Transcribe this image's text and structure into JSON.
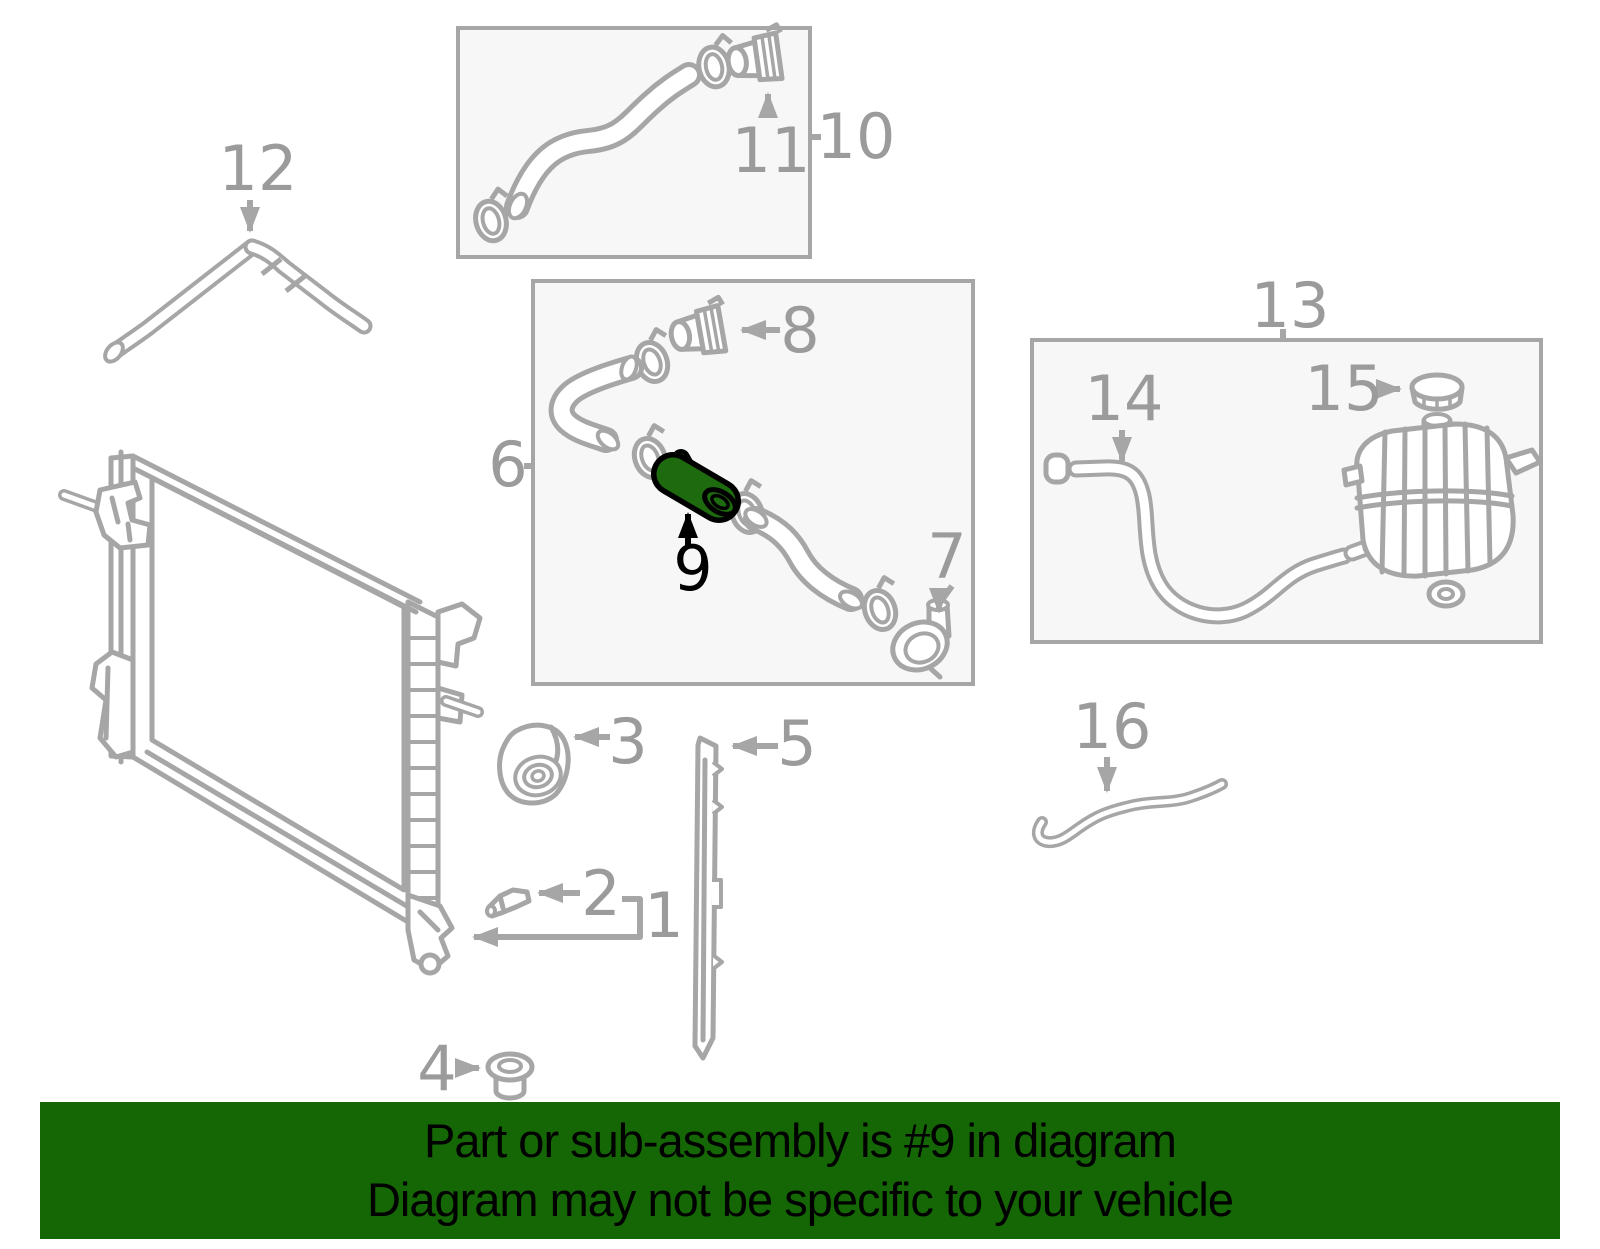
{
  "banner": {
    "line1": "Part or sub-assembly is #9 in diagram",
    "line2": "Diagram may not be specific to your vehicle",
    "background_color": "#156605",
    "text_color": "#000000"
  },
  "diagram": {
    "highlighted_callout": "9",
    "line_color": "#a6a6a6",
    "label_color": "#9b9b9b",
    "box_fill": "#f7f7f7",
    "highlight_fill": "#1e6a0e",
    "highlight_outline": "#000000",
    "callouts": [
      {
        "num": "1"
      },
      {
        "num": "2"
      },
      {
        "num": "3"
      },
      {
        "num": "4"
      },
      {
        "num": "5"
      },
      {
        "num": "6"
      },
      {
        "num": "7"
      },
      {
        "num": "8"
      },
      {
        "num": "9"
      },
      {
        "num": "10"
      },
      {
        "num": "11"
      },
      {
        "num": "12"
      },
      {
        "num": "13"
      },
      {
        "num": "14"
      },
      {
        "num": "15"
      },
      {
        "num": "16"
      }
    ]
  }
}
